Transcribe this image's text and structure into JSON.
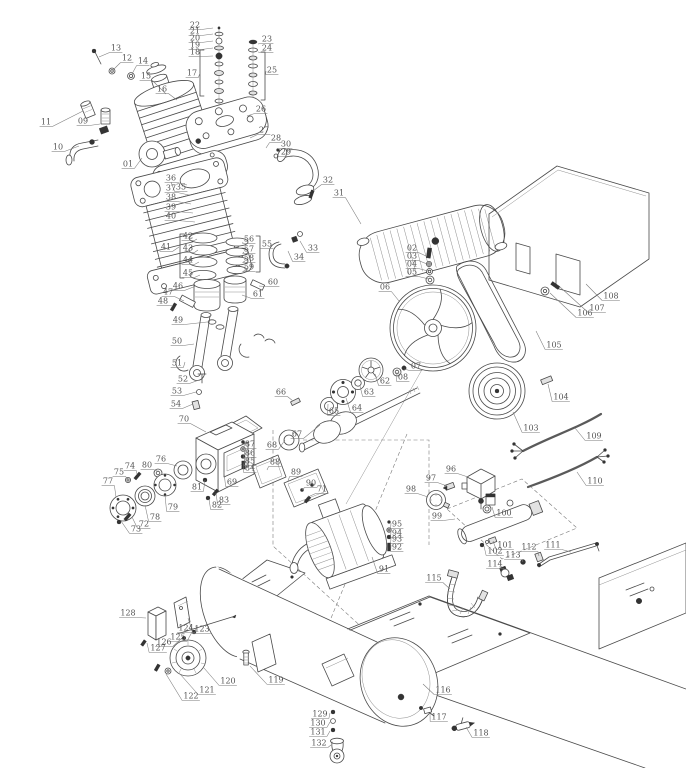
{
  "diagram": {
    "type": "exploded-parts-diagram",
    "subject": "belt-drive air compressor",
    "colors": {
      "background": "#ffffff",
      "line": "#4a4a4a",
      "label": "#555555",
      "leader": "#7a7a7a",
      "dark": "#333333"
    },
    "callouts": [
      {
        "n": "01",
        "x": 128,
        "y": 164,
        "tx": 142,
        "ty": 158
      },
      {
        "n": "02",
        "x": 412,
        "y": 248,
        "tx": 426,
        "ty": 256
      },
      {
        "n": "03",
        "x": 412,
        "y": 256,
        "tx": 427,
        "ty": 264
      },
      {
        "n": "04",
        "x": 412,
        "y": 264,
        "tx": 428,
        "ty": 271
      },
      {
        "n": "05",
        "x": 412,
        "y": 272,
        "tx": 429,
        "ty": 279
      },
      {
        "n": "06",
        "x": 385,
        "y": 287,
        "tx": 399,
        "ty": 301
      },
      {
        "n": "07",
        "x": 416,
        "y": 366,
        "tx": 404,
        "ty": 369
      },
      {
        "n": "08",
        "x": 403,
        "y": 377,
        "tx": 397,
        "ty": 372
      },
      {
        "n": "09",
        "x": 83,
        "y": 121,
        "tx": 100,
        "ty": 124
      },
      {
        "n": "10",
        "x": 58,
        "y": 147,
        "tx": 79,
        "ty": 146
      },
      {
        "n": "11",
        "x": 46,
        "y": 122,
        "tx": 83,
        "ty": 111
      },
      {
        "n": "12",
        "x": 127,
        "y": 58,
        "tx": 113,
        "ty": 70
      },
      {
        "n": "13",
        "x": 116,
        "y": 48,
        "tx": 99,
        "ty": 57
      },
      {
        "n": "14",
        "x": 143,
        "y": 61,
        "tx": 132,
        "ty": 74
      },
      {
        "n": "15",
        "x": 146,
        "y": 76,
        "tx": 166,
        "ty": 94
      },
      {
        "n": "16",
        "x": 162,
        "y": 89,
        "tx": 177,
        "ty": 100
      },
      {
        "n": "17",
        "x": 192,
        "y": 73,
        "tx": 200,
        "ty": 73
      },
      {
        "n": "18",
        "x": 195,
        "y": 52,
        "tx": 213,
        "ty": 56
      },
      {
        "n": "19",
        "x": 195,
        "y": 45,
        "tx": 213,
        "ty": 48
      },
      {
        "n": "20",
        "x": 195,
        "y": 38,
        "tx": 213,
        "ty": 41
      },
      {
        "n": "21",
        "x": 195,
        "y": 31,
        "tx": 213,
        "ty": 34
      },
      {
        "n": "22",
        "x": 195,
        "y": 25,
        "tx": 213,
        "ty": 28
      },
      {
        "n": "23",
        "x": 267,
        "y": 39,
        "tx": 258,
        "ty": 44
      },
      {
        "n": "24",
        "x": 267,
        "y": 48,
        "tx": 258,
        "ty": 52
      },
      {
        "n": "25",
        "x": 272,
        "y": 70,
        "tx": 266,
        "ty": 71
      },
      {
        "n": "26",
        "x": 261,
        "y": 109,
        "tx": 247,
        "ty": 116
      },
      {
        "n": "27",
        "x": 264,
        "y": 130,
        "tx": 250,
        "ty": 138
      },
      {
        "n": "28",
        "x": 276,
        "y": 138,
        "tx": 266,
        "ty": 148
      },
      {
        "n": "29",
        "x": 286,
        "y": 152,
        "tx": 278,
        "ty": 157
      },
      {
        "n": "30",
        "x": 286,
        "y": 144,
        "tx": 278,
        "ty": 149
      },
      {
        "n": "31",
        "x": 339,
        "y": 193,
        "tx": 361,
        "ty": 224
      },
      {
        "n": "32",
        "x": 328,
        "y": 180,
        "tx": 313,
        "ty": 191
      },
      {
        "n": "33",
        "x": 313,
        "y": 248,
        "tx": 300,
        "ty": 241
      },
      {
        "n": "34",
        "x": 299,
        "y": 257,
        "tx": 288,
        "ty": 251
      },
      {
        "n": "35",
        "x": 181,
        "y": 187,
        "tx": 171,
        "ty": 182
      },
      {
        "n": "36",
        "x": 171,
        "y": 178,
        "tx": 187,
        "ty": 185
      },
      {
        "n": "37",
        "x": 171,
        "y": 188,
        "tx": 189,
        "ty": 195
      },
      {
        "n": "38",
        "x": 171,
        "y": 197,
        "tx": 191,
        "ty": 204
      },
      {
        "n": "39",
        "x": 171,
        "y": 207,
        "tx": 193,
        "ty": 213
      },
      {
        "n": "40",
        "x": 171,
        "y": 216,
        "tx": 195,
        "ty": 222
      },
      {
        "n": "41",
        "x": 166,
        "y": 247,
        "tx": 179,
        "ty": 247
      },
      {
        "n": "42",
        "x": 188,
        "y": 236,
        "tx": 197,
        "ty": 239
      },
      {
        "n": "43",
        "x": 188,
        "y": 248,
        "tx": 198,
        "ty": 250
      },
      {
        "n": "44",
        "x": 188,
        "y": 260,
        "tx": 199,
        "ty": 262
      },
      {
        "n": "45",
        "x": 188,
        "y": 273,
        "tx": 200,
        "ty": 275
      },
      {
        "n": "46",
        "x": 178,
        "y": 286,
        "tx": 196,
        "ty": 286
      },
      {
        "n": "47",
        "x": 168,
        "y": 292,
        "tx": 184,
        "ty": 301
      },
      {
        "n": "48",
        "x": 163,
        "y": 301,
        "tx": 173,
        "ty": 306
      },
      {
        "n": "49",
        "x": 178,
        "y": 320,
        "tx": 207,
        "ty": 322
      },
      {
        "n": "50",
        "x": 177,
        "y": 341,
        "tx": 194,
        "ty": 344
      },
      {
        "n": "51",
        "x": 177,
        "y": 363,
        "tx": 185,
        "ty": 362
      },
      {
        "n": "52",
        "x": 183,
        "y": 379,
        "tx": 199,
        "ty": 380
      },
      {
        "n": "53",
        "x": 177,
        "y": 391,
        "tx": 196,
        "ty": 392
      },
      {
        "n": "54",
        "x": 176,
        "y": 404,
        "tx": 193,
        "ty": 404
      },
      {
        "n": "55",
        "x": 267,
        "y": 244,
        "tx": 260,
        "ty": 248
      },
      {
        "n": "56",
        "x": 249,
        "y": 239,
        "tx": 243,
        "ty": 242
      },
      {
        "n": "57",
        "x": 249,
        "y": 249,
        "tx": 244,
        "ty": 252
      },
      {
        "n": "58",
        "x": 249,
        "y": 258,
        "tx": 245,
        "ty": 261
      },
      {
        "n": "59",
        "x": 249,
        "y": 267,
        "tx": 246,
        "ty": 270
      },
      {
        "n": "60",
        "x": 273,
        "y": 282,
        "tx": 259,
        "ty": 286
      },
      {
        "n": "61",
        "x": 258,
        "y": 294,
        "tx": 242,
        "ty": 295
      },
      {
        "n": "62",
        "x": 385,
        "y": 381,
        "tx": 375,
        "ty": 374
      },
      {
        "n": "63",
        "x": 369,
        "y": 392,
        "tx": 360,
        "ty": 386
      },
      {
        "n": "64",
        "x": 357,
        "y": 408,
        "tx": 346,
        "ty": 398
      },
      {
        "n": "65",
        "x": 334,
        "y": 411,
        "tx": 328,
        "ty": 404
      },
      {
        "n": "66",
        "x": 281,
        "y": 392,
        "tx": 293,
        "ty": 401
      },
      {
        "n": "67",
        "x": 297,
        "y": 434,
        "tx": 320,
        "ty": 425
      },
      {
        "n": "68",
        "x": 272,
        "y": 445,
        "tx": 285,
        "ty": 440
      },
      {
        "n": "69",
        "x": 232,
        "y": 482,
        "tx": 224,
        "ty": 472
      },
      {
        "n": "70",
        "x": 184,
        "y": 419,
        "tx": 206,
        "ty": 432
      },
      {
        "n": "71",
        "x": 322,
        "y": 489,
        "tx": 308,
        "ty": 497
      },
      {
        "n": "72",
        "x": 144,
        "y": 524,
        "tx": 132,
        "ty": 517
      },
      {
        "n": "73",
        "x": 136,
        "y": 529,
        "tx": 121,
        "ty": 521
      },
      {
        "n": "74",
        "x": 130,
        "y": 466,
        "tx": 137,
        "ty": 474
      },
      {
        "n": "75",
        "x": 119,
        "y": 472,
        "tx": 128,
        "ty": 479
      },
      {
        "n": "76",
        "x": 161,
        "y": 459,
        "tx": 177,
        "ty": 466
      },
      {
        "n": "77",
        "x": 108,
        "y": 481,
        "tx": 116,
        "ty": 497
      },
      {
        "n": "78",
        "x": 155,
        "y": 517,
        "tx": 145,
        "ty": 505
      },
      {
        "n": "79",
        "x": 173,
        "y": 507,
        "tx": 165,
        "ty": 495
      },
      {
        "n": "80",
        "x": 147,
        "y": 465,
        "tx": 157,
        "ty": 471
      },
      {
        "n": "81",
        "x": 197,
        "y": 487,
        "tx": 205,
        "ty": 480
      },
      {
        "n": "82",
        "x": 217,
        "y": 505,
        "tx": 209,
        "ty": 499
      },
      {
        "n": "83",
        "x": 224,
        "y": 500,
        "tx": 216,
        "ty": 493
      },
      {
        "n": "84",
        "x": 250,
        "y": 468,
        "tx": 244,
        "ty": 464
      },
      {
        "n": "85",
        "x": 250,
        "y": 461,
        "tx": 245,
        "ty": 457
      },
      {
        "n": "86",
        "x": 250,
        "y": 453,
        "tx": 245,
        "ty": 450
      },
      {
        "n": "87",
        "x": 250,
        "y": 444,
        "tx": 245,
        "ty": 442
      },
      {
        "n": "88",
        "x": 275,
        "y": 462,
        "tx": 267,
        "ty": 470
      },
      {
        "n": "89",
        "x": 296,
        "y": 472,
        "tx": 288,
        "ty": 481
      },
      {
        "n": "90",
        "x": 311,
        "y": 483,
        "tx": 302,
        "ty": 490
      },
      {
        "n": "91",
        "x": 384,
        "y": 569,
        "tx": 372,
        "ty": 557
      },
      {
        "n": "92",
        "x": 397,
        "y": 547,
        "tx": 391,
        "ty": 545
      },
      {
        "n": "93",
        "x": 397,
        "y": 539,
        "tx": 391,
        "ty": 538
      },
      {
        "n": "94",
        "x": 397,
        "y": 533,
        "tx": 391,
        "ty": 531
      },
      {
        "n": "95",
        "x": 397,
        "y": 524,
        "tx": 391,
        "ty": 523
      },
      {
        "n": "96",
        "x": 451,
        "y": 469,
        "tx": 468,
        "ty": 477
      },
      {
        "n": "97",
        "x": 431,
        "y": 478,
        "tx": 447,
        "ty": 486
      },
      {
        "n": "98",
        "x": 411,
        "y": 489,
        "tx": 428,
        "ty": 497
      },
      {
        "n": "99",
        "x": 437,
        "y": 516,
        "tx": 455,
        "ty": 519
      },
      {
        "n": "100",
        "x": 504,
        "y": 513,
        "tx": 492,
        "ty": 507
      },
      {
        "n": "101",
        "x": 505,
        "y": 545,
        "tx": 493,
        "ty": 541
      },
      {
        "n": "102",
        "x": 495,
        "y": 551,
        "tx": 484,
        "ty": 546
      },
      {
        "n": "103",
        "x": 531,
        "y": 428,
        "tx": 513,
        "ty": 412
      },
      {
        "n": "104",
        "x": 561,
        "y": 397,
        "tx": 548,
        "ty": 384
      },
      {
        "n": "105",
        "x": 554,
        "y": 345,
        "tx": 536,
        "ty": 331
      },
      {
        "n": "106",
        "x": 585,
        "y": 313,
        "tx": 550,
        "ty": 293
      },
      {
        "n": "107",
        "x": 597,
        "y": 308,
        "tx": 560,
        "ty": 287
      },
      {
        "n": "108",
        "x": 611,
        "y": 296,
        "tx": 586,
        "ty": 284
      },
      {
        "n": "109",
        "x": 594,
        "y": 436,
        "tx": 575,
        "ty": 428
      },
      {
        "n": "110",
        "x": 595,
        "y": 481,
        "tx": 577,
        "ty": 472
      },
      {
        "n": "111",
        "x": 553,
        "y": 545,
        "tx": 571,
        "ty": 552
      },
      {
        "n": "112",
        "x": 529,
        "y": 547,
        "tx": 539,
        "ty": 556
      },
      {
        "n": "113",
        "x": 513,
        "y": 555,
        "tx": 523,
        "ty": 562
      },
      {
        "n": "114",
        "x": 495,
        "y": 564,
        "tx": 504,
        "ty": 570
      },
      {
        "n": "115",
        "x": 434,
        "y": 578,
        "tx": 450,
        "ty": 589
      },
      {
        "n": "116",
        "x": 443,
        "y": 690,
        "tx": 423,
        "ty": 684
      },
      {
        "n": "117",
        "x": 439,
        "y": 717,
        "tx": 430,
        "ty": 713
      },
      {
        "n": "118",
        "x": 481,
        "y": 733,
        "tx": 466,
        "ty": 727
      },
      {
        "n": "119",
        "x": 276,
        "y": 680,
        "tx": 250,
        "ty": 666
      },
      {
        "n": "120",
        "x": 228,
        "y": 681,
        "tx": 204,
        "ty": 668
      },
      {
        "n": "121",
        "x": 207,
        "y": 690,
        "tx": 180,
        "ty": 674
      },
      {
        "n": "122",
        "x": 191,
        "y": 696,
        "tx": 166,
        "ty": 674
      },
      {
        "n": "123",
        "x": 202,
        "y": 629,
        "tx": 188,
        "ty": 618
      },
      {
        "n": "124",
        "x": 186,
        "y": 628,
        "tx": 197,
        "ty": 625
      },
      {
        "n": "125",
        "x": 178,
        "y": 637,
        "tx": 192,
        "ty": 632
      },
      {
        "n": "126",
        "x": 164,
        "y": 642,
        "tx": 182,
        "ty": 638
      },
      {
        "n": "127",
        "x": 158,
        "y": 648,
        "tx": 147,
        "ty": 643
      },
      {
        "n": "128",
        "x": 128,
        "y": 613,
        "tx": 146,
        "ty": 618
      },
      {
        "n": "129",
        "x": 320,
        "y": 714,
        "tx": 330,
        "ty": 713
      },
      {
        "n": "130",
        "x": 318,
        "y": 723,
        "tx": 330,
        "ty": 722
      },
      {
        "n": "131",
        "x": 318,
        "y": 732,
        "tx": 330,
        "ty": 731
      },
      {
        "n": "132",
        "x": 319,
        "y": 743,
        "tx": 331,
        "ty": 745
      }
    ]
  }
}
